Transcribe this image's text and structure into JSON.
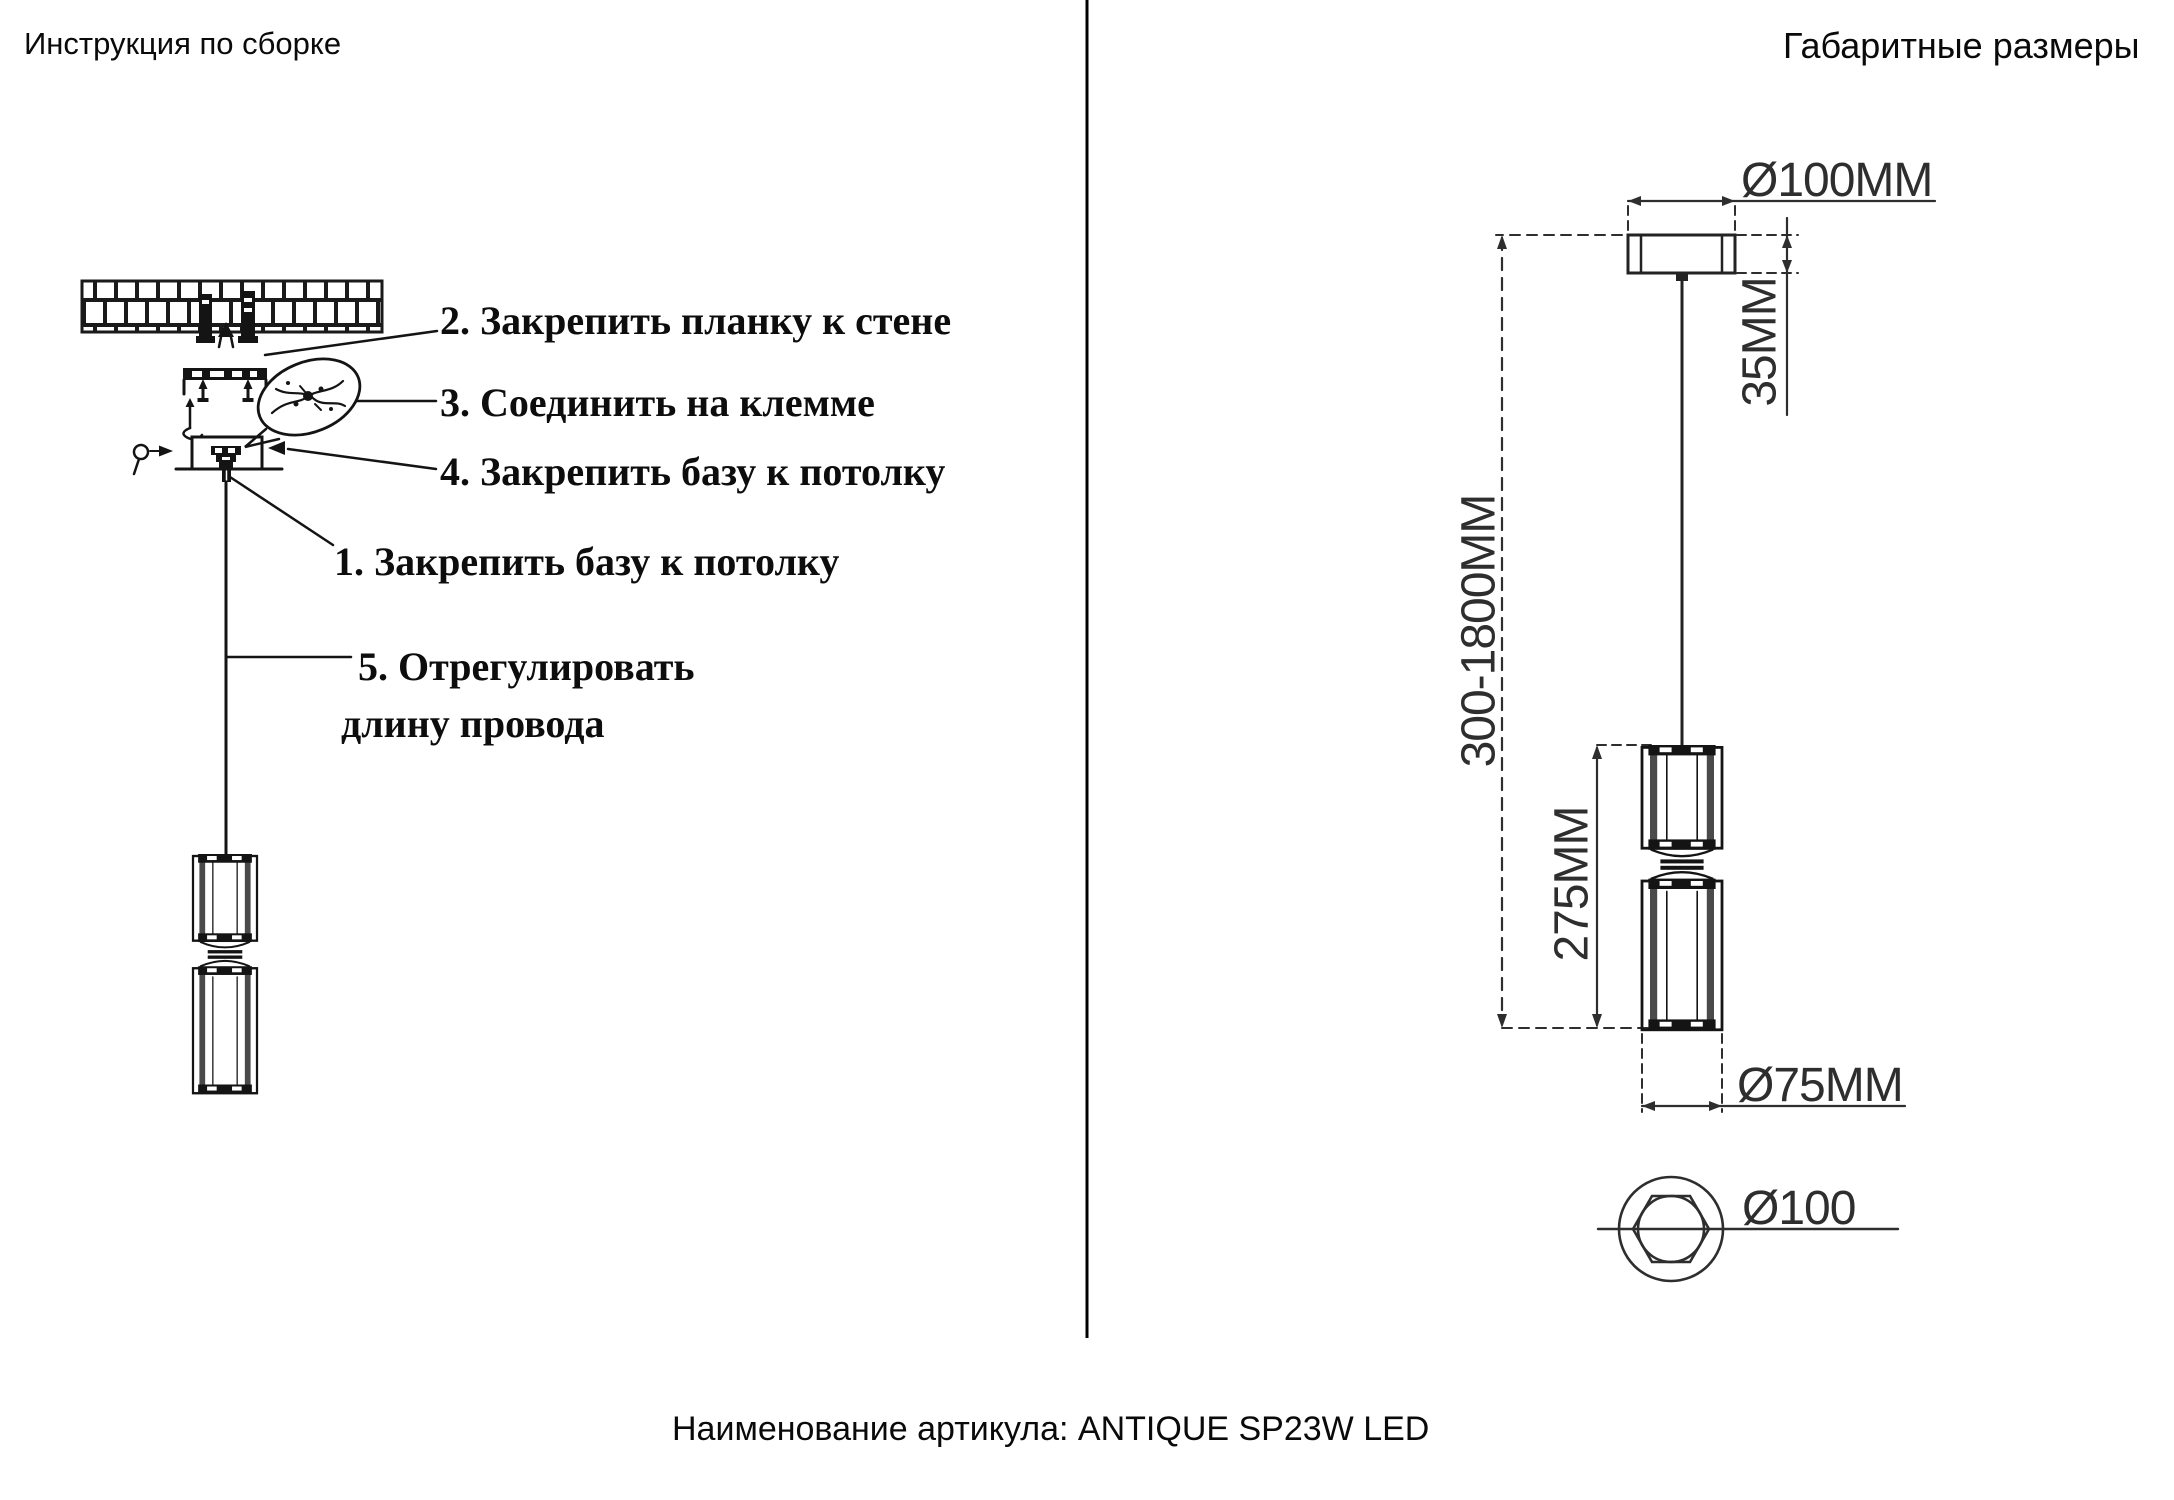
{
  "page": {
    "left_title": "Инструкция по сборке",
    "right_title": "Габаритные размеры",
    "footer_article": "Наименование артикула: ANTIQUE SP23W LED"
  },
  "assembly": {
    "steps": {
      "step2": "2. Закрепить планку к стене",
      "step3": "3. Соединить на клемме",
      "step4": "4. Закрепить базу к потолку",
      "step1": "1. Закрепить базу к потолку",
      "step5_line1": "5. Отрегулировать",
      "step5_line2": "длину провода"
    }
  },
  "dimensions": {
    "canopy_diameter": "Ø100MM",
    "canopy_height": "35MM",
    "suspension_length": "300-1800MM",
    "body_height": "275MM",
    "body_diameter": "Ø75MM",
    "canopy_bottom_diameter": "Ø100"
  }
}
